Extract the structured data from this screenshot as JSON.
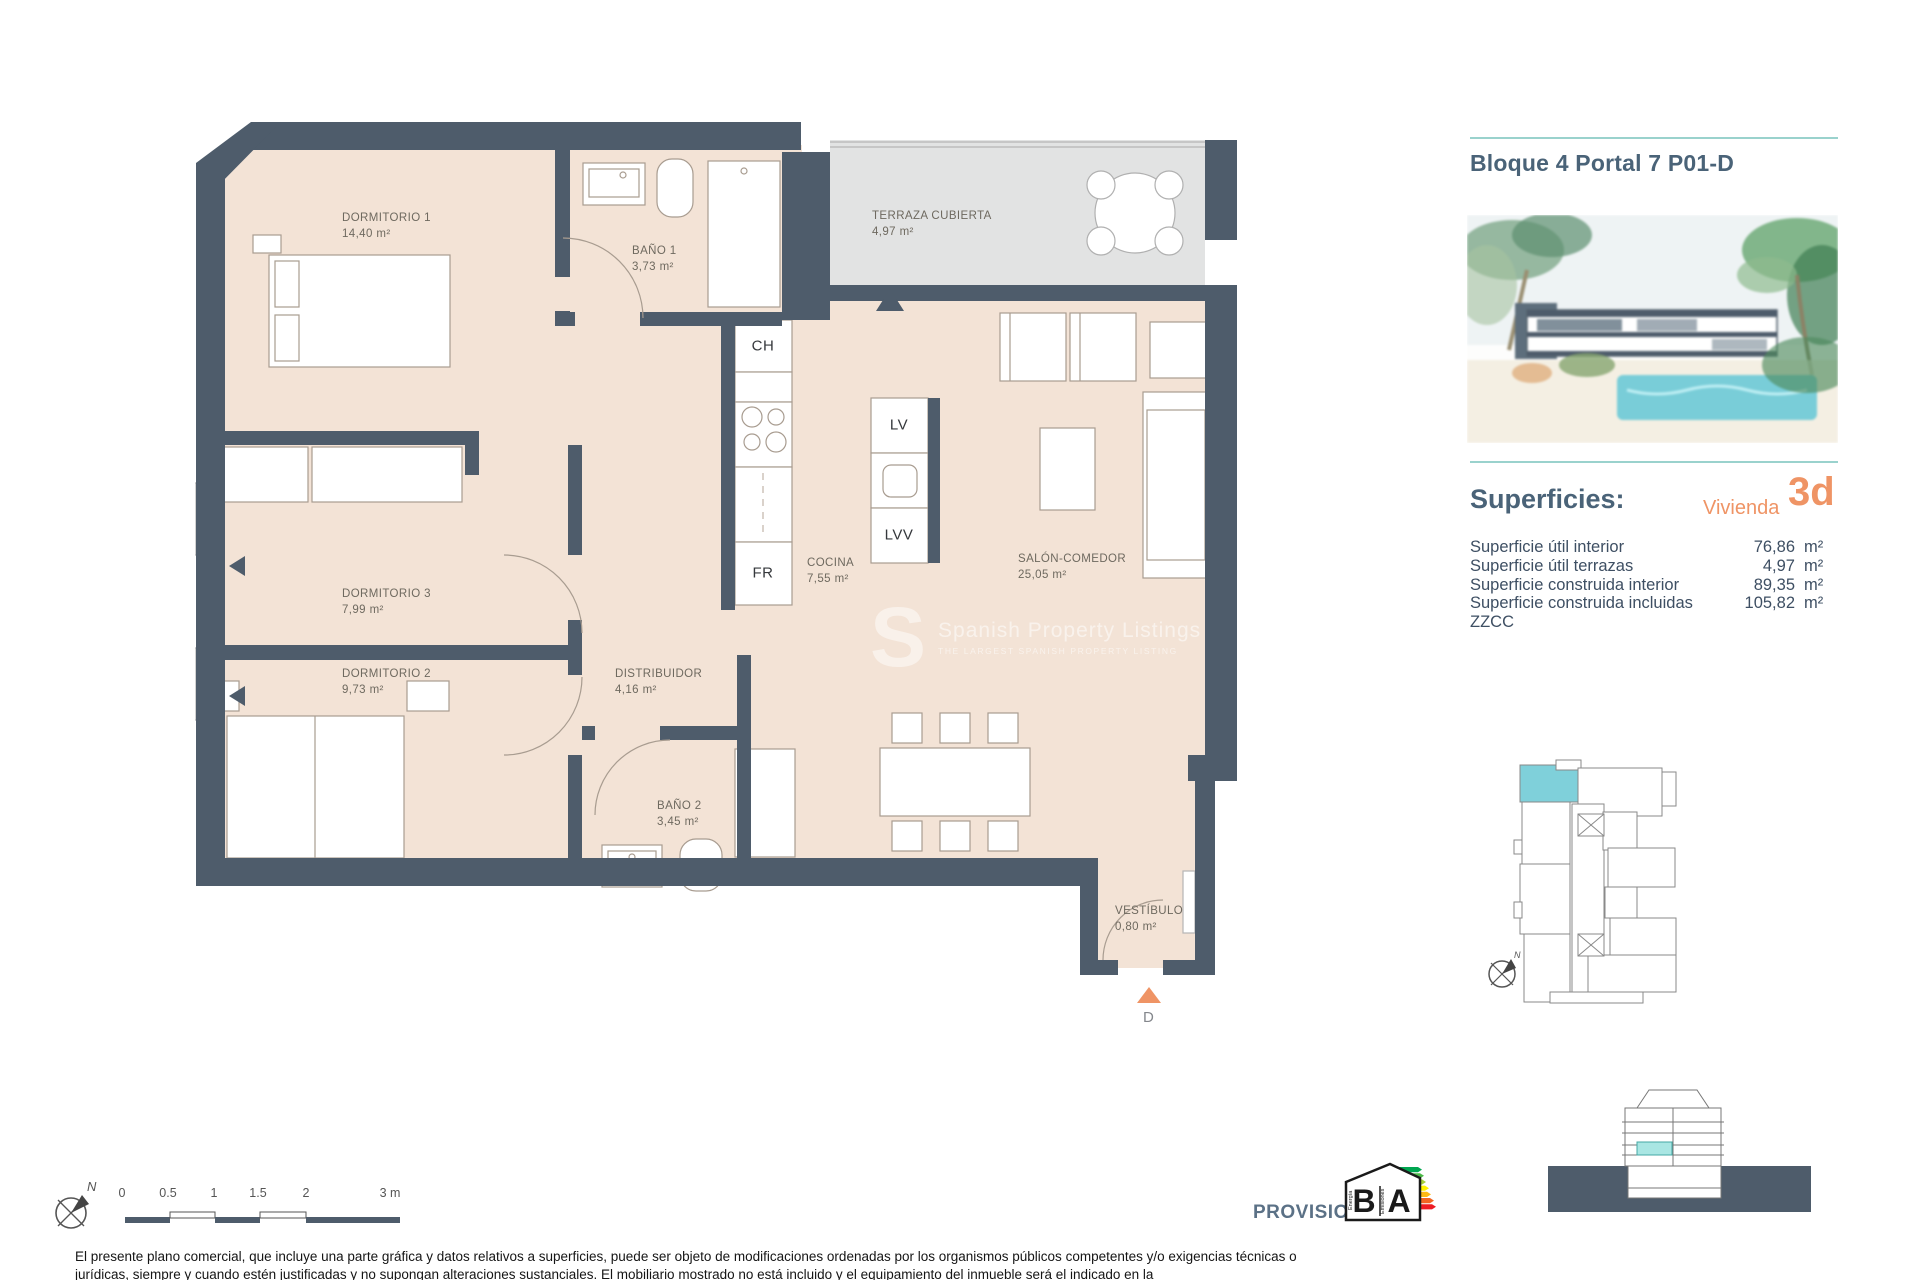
{
  "header": {
    "title": "Bloque 4 Portal 7 P01-D"
  },
  "superficies": {
    "heading": "Superficies:",
    "vivienda_label": "Vivienda",
    "vivienda_code": "3d",
    "rows": [
      {
        "label": "Superficie útil interior",
        "value": "76,86",
        "unit": "m²"
      },
      {
        "label": "Superficie útil terrazas",
        "value": "4,97",
        "unit": "m²"
      },
      {
        "label": "Superficie construida interior",
        "value": "89,35",
        "unit": "m²"
      },
      {
        "label": "Superficie construida incluidas ZZCC",
        "value": "105,82",
        "unit": "m²"
      }
    ]
  },
  "plan": {
    "rooms": {
      "dormitorio1": {
        "name": "DORMITORIO 1",
        "area": "14,40 m²"
      },
      "bano1": {
        "name": "BAÑO 1",
        "area": "3,73 m²"
      },
      "terraza": {
        "name": "TERRAZA CUBIERTA",
        "area": "4,97 m²"
      },
      "dormitorio3": {
        "name": "DORMITORIO 3",
        "area": "7,99 m²"
      },
      "dormitorio2": {
        "name": "DORMITORIO 2",
        "area": "9,73 m²"
      },
      "distribuidor": {
        "name": "DISTRIBUIDOR",
        "area": "4,16 m²"
      },
      "cocina": {
        "name": "COCINA",
        "area": "7,55 m²"
      },
      "salon": {
        "name": "SALÓN-COMEDOR",
        "area": "25,05 m²"
      },
      "bano2": {
        "name": "BAÑO 2",
        "area": "3,45 m²"
      },
      "vestibulo": {
        "name": "VESTÍBULO",
        "area": "0,80 m²"
      }
    },
    "appliances": {
      "ch": "CH",
      "lv": "LV",
      "lvv": "LVV",
      "fr": "FR"
    },
    "entrance_label": "D",
    "compass_label": "N"
  },
  "watermark": {
    "logo": "S",
    "line1": "Spanish Property Listings",
    "line2": "THE LARGEST SPANISH PROPERTY LISTING"
  },
  "scalebar": {
    "ticks": [
      "0",
      "0.5",
      "1",
      "1.5",
      "2",
      "3 m"
    ]
  },
  "keyplan": {
    "compass_label": "N"
  },
  "footer": {
    "provisional": "PROVISIONAL",
    "energy": {
      "left_letter": "B",
      "right_letter": "A",
      "left_caption": "Energía",
      "right_caption": "Emisiones"
    },
    "disclaimer": "El presente plano comercial, que incluye una parte gráfica y datos relativos a superficies, puede ser objeto de modificaciones ordenadas por los organismos públicos competentes y/o exigencias técnicas o jurídicas, siempre y cuando estén justificadas y no supongan alteraciones sustanciales. El mobiliario mostrado no está incluido y el equipamiento del inmueble será el indicado en la"
  },
  "colors": {
    "wall": "#4e5c6b",
    "floor": "#f3e3d6",
    "terrace": "#e2e3e3",
    "accent_orange": "#ef9465",
    "accent_teal": "#9ad2cd",
    "heading_blue": "#4a6378",
    "unit_cyan": "#7fd0da"
  }
}
